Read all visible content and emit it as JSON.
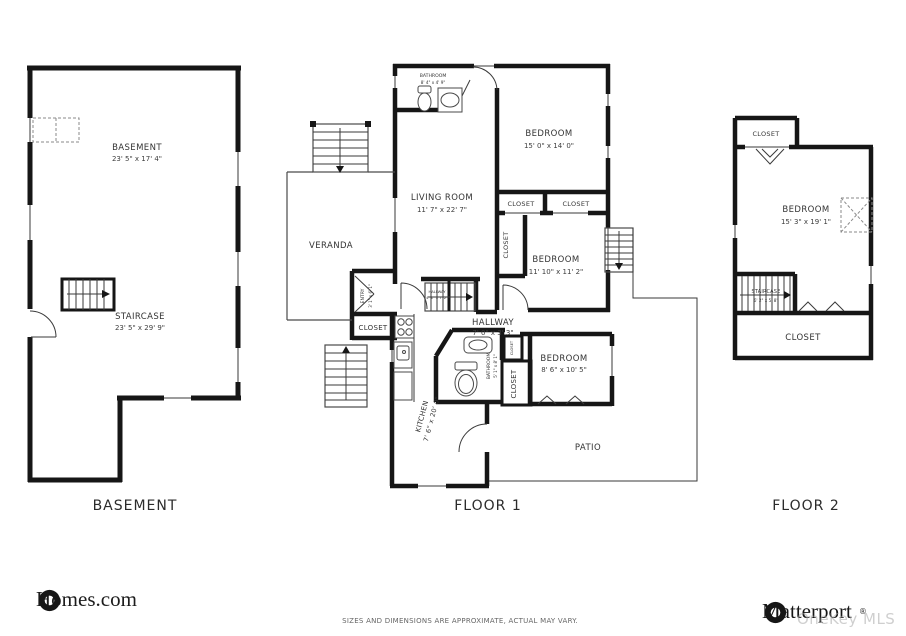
{
  "basement": {
    "room": {
      "name": "BASEMENT",
      "dims": "23' 5\" x 17' 4\""
    },
    "staircase": {
      "name": "STAIRCASE",
      "dims": "23' 5\" x 29' 9\""
    },
    "caption": "BASEMENT"
  },
  "floor1": {
    "caption": "FLOOR 1",
    "bathroom_top": {
      "name": "BATHROOM",
      "dims": "8' 4\" x 4' 9\""
    },
    "bedroom1": {
      "name": "BEDROOM",
      "dims": "15' 0\" x 14' 0\""
    },
    "living_room": {
      "name": "LIVING ROOM",
      "dims": "11' 7\" x 22' 7\""
    },
    "closet_a": "CLOSET",
    "closet_b": "CLOSET",
    "closet_left": "CLOSET",
    "bedroom2": {
      "name": "BEDROOM",
      "dims": "11' 10\" x 11' 2\""
    },
    "veranda": "VERANDA",
    "entry": {
      "name": "ENTRY",
      "dims": "3' 1\" x 6' 1\""
    },
    "inner_stairs": {
      "name": "HALLWAY",
      "dims": "4' 1\" x 7' 2\""
    },
    "closet_entry": "CLOSET",
    "hallway": {
      "name": "HALLWAY",
      "dims": "7' 0\" x 3' 3\""
    },
    "bathroom_mid": {
      "name": "BATHROOM",
      "dims": "5' 1\" x 8' 1\""
    },
    "closet_tiny": "CLOSET",
    "closet_right": "CLOSET",
    "bedroom3": {
      "name": "BEDROOM",
      "dims": "8' 6\" x 10' 5\""
    },
    "kitchen": {
      "name": "KITCHEN",
      "dims": "7' 6\" x 20' 0\""
    },
    "patio": "PATIO"
  },
  "floor2": {
    "caption": "FLOOR 2",
    "closet_top": "CLOSET",
    "bedroom": {
      "name": "BEDROOM",
      "dims": "15' 3\" x 19' 1\""
    },
    "staircase": {
      "name": "STAIRCASE",
      "dims": "6' 2\" x 5' 8\""
    },
    "closet_bottom": "CLOSET"
  },
  "footer": {
    "homes_logo": "Homes.com",
    "disclaimer": "SIZES AND DIMENSIONS ARE APPROXIMATE, ACTUAL MAY VARY.",
    "matterport_logo": "Matterport",
    "matterport_reg": "®",
    "watermark": "OneKey MLS"
  }
}
